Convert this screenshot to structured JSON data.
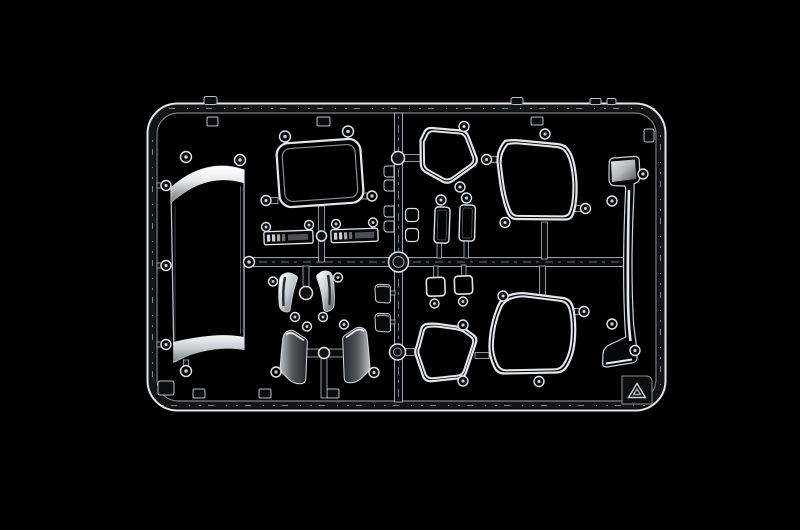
{
  "scene": {
    "description": "Product photograph of a clear (transparent) injection-molded model kit sprue with vehicle window and deflector parts on a black background",
    "background_color": "#000000",
    "object": "clear parts sprue",
    "visible_text": ""
  },
  "palette": {
    "background": "#000000",
    "bright_edge": "#e3e7ea",
    "mid_edge": "#aeb4ba",
    "dim_edge": "#7e8388",
    "chrome_highlight": "#ffffff",
    "part_interior": "#050506"
  },
  "parts": {
    "windscreen": {
      "label": "large curved windscreen glass panel with bright chrome-like top and bottom bands"
    },
    "roof_window": {
      "label": "rounded rectangular roof window pane, tilted"
    },
    "strip_left": {
      "label": "left clear lamp lens strip with ribbed segments"
    },
    "strip_right": {
      "label": "right clear lamp lens strip with ribbed segments"
    },
    "clips": {
      "label": "column of four small clear clips on center runner"
    },
    "tab_rings": {
      "label": "two small rounded clear tabs on center runner"
    },
    "mirror_left": {
      "label": "left tall mirror glass pane"
    },
    "mirror_right": {
      "label": "right tall mirror glass pane"
    },
    "vent_upper": {
      "label": "upper quarter vent window pane"
    },
    "door_upper": {
      "label": "upper large door window pane"
    },
    "pillar": {
      "label": "long curved A-pillar wind deflector with bright highlight"
    },
    "square_left": {
      "label": "left small square lens pane"
    },
    "square_right": {
      "label": "right small square lens pane"
    },
    "housing_upper": {
      "label": "upper small mirror housing piece beside center runner"
    },
    "housing_lower": {
      "label": "lower small mirror housing piece beside center runner"
    },
    "corner_defl_left": {
      "label": "left small corner wind deflector blade"
    },
    "corner_defl_right": {
      "label": "right small corner wind deflector blade"
    },
    "deflector_left": {
      "label": "left large door wind deflector panel"
    },
    "deflector_right": {
      "label": "right large door wind deflector panel"
    },
    "quarter_lower": {
      "label": "lower quarter window pane"
    },
    "door_lower": {
      "label": "lower large door window pane"
    },
    "recycle_mark": {
      "label": "molded recycling triangle mark in bottom right frame corner"
    },
    "frame": {
      "label": "rounded rectangular sprue frame with molding tabs and gates"
    }
  }
}
